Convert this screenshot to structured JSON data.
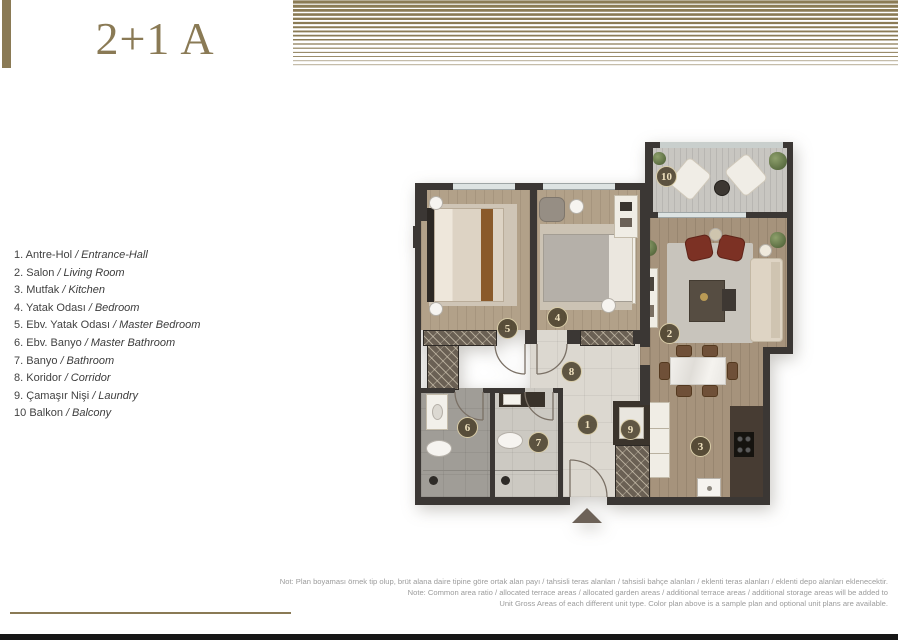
{
  "page": {
    "title": "2+1 A",
    "accent": "#8a7a55"
  },
  "legend": {
    "separator": "/",
    "items": [
      {
        "num": "1.",
        "tr": "Antre-Hol",
        "en": "Entrance-Hall"
      },
      {
        "num": "2.",
        "tr": "Salon",
        "en": "Living Room"
      },
      {
        "num": "3.",
        "tr": "Mutfak",
        "en": "Kitchen"
      },
      {
        "num": "4.",
        "tr": "Yatak Odası",
        "en": "Bedroom"
      },
      {
        "num": "5.",
        "tr": "Ebv. Yatak Odası",
        "en": "Master Bedroom"
      },
      {
        "num": "6.",
        "tr": "Ebv. Banyo",
        "en": "Master Bathroom"
      },
      {
        "num": "7.",
        "tr": "Banyo",
        "en": "Bathroom"
      },
      {
        "num": "8.",
        "tr": "Koridor",
        "en": "Corridor"
      },
      {
        "num": "9.",
        "tr": "Çamaşır Nişi",
        "en": "Laundry"
      },
      {
        "num": "10",
        "tr": "Balkon",
        "en": "Balcony"
      }
    ]
  },
  "plan": {
    "badges": [
      "1",
      "2",
      "3",
      "4",
      "5",
      "6",
      "7",
      "8",
      "9",
      "10"
    ]
  },
  "footnote": {
    "line1": "Not: Plan boyaması örnek tip olup, brüt alana daire tipine göre ortak alan payı / tahsisli teras alanları / tahsisli bahçe alanları / eklenti teras alanları / eklenti depo alanları eklenecektir.",
    "line2": "Note: Common area ratio / allocated terrace areas / allocated garden areas / additional terrace areas / additional storage areas will be added to",
    "line3": "Unit Gross Areas of each different unit type. Color plan above is a sample plan and optional unit plans are available."
  },
  "colors": {
    "accent": "#8a7a55",
    "wall": "#3b3734",
    "wood": "#b2a189",
    "tile": "#dcd8d0",
    "deck": "#c8c6c1"
  }
}
